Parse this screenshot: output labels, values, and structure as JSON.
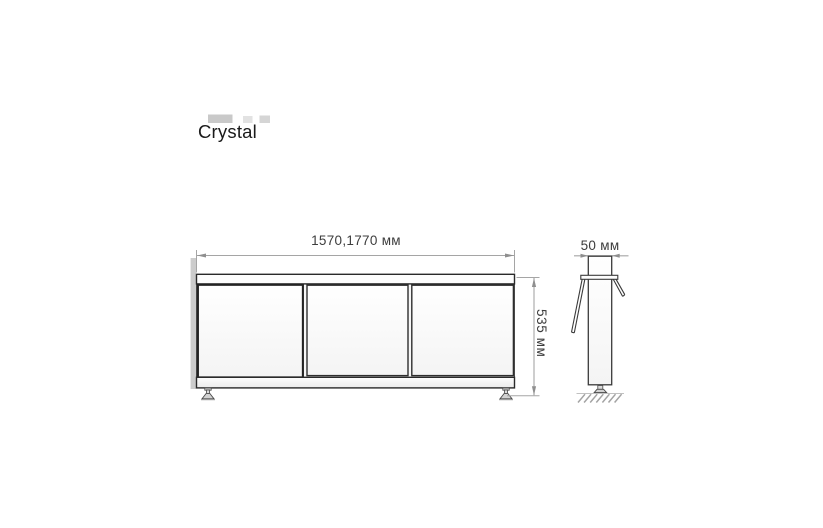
{
  "title": "Crystal",
  "front_view": {
    "width_label": "1570,1770 мм",
    "height_label": "535 мм"
  },
  "side_view": {
    "depth_label": "50 мм"
  },
  "colors": {
    "background": "#ffffff",
    "drawing_outline": "#2f2f2f",
    "panel_fill": "#fafafa",
    "dimension_line": "#a5a5a5",
    "dimension_text": "#3d3d3d",
    "title_text": "#1a1a1a",
    "shadow_strip": "#c3c3c3",
    "ground_hatch": "#a3a3a3",
    "artifact_gray": "#d2d2d2"
  }
}
